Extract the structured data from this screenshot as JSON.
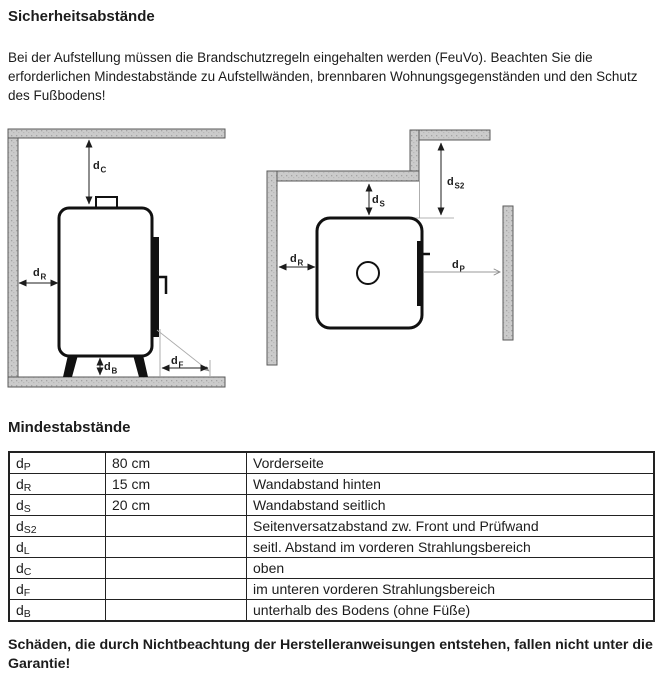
{
  "page": {
    "title": "Sicherheitsabstände",
    "intro": "Bei der Aufstellung müssen die Brandschutzregeln eingehalten werden (FeuVo). Beachten Sie die erforderlichen Mindestabstände zu Aufstellwänden, brennbaren Wohnungsgegenständen und den Schutz des Fußbodens!",
    "section2_title": "Mindestabstände",
    "warning": "Schäden, die durch Nichtbeachtung der Herstelleranweisungen entstehen, fallen nicht unter die Garantie!"
  },
  "colors": {
    "wall_fill": "#cbcbcb",
    "line": "#1c1c1c",
    "thin_line": "#9a9a9a"
  },
  "diagram": {
    "left": {
      "dC": {
        "base": "d",
        "sub": "C"
      },
      "dR": {
        "base": "d",
        "sub": "R"
      },
      "dB": {
        "base": "d",
        "sub": "B"
      },
      "dF": {
        "base": "d",
        "sub": "F"
      }
    },
    "right": {
      "dS": {
        "base": "d",
        "sub": "S"
      },
      "dS2": {
        "base": "d",
        "sub": "S2"
      },
      "dR": {
        "base": "d",
        "sub": "R"
      },
      "dP": {
        "base": "d",
        "sub": "P"
      }
    }
  },
  "table": {
    "rows": [
      {
        "base": "d",
        "sub": "P",
        "value": "80 cm",
        "desc": "Vorderseite"
      },
      {
        "base": "d",
        "sub": "R",
        "value": "15 cm",
        "desc": "Wandabstand hinten"
      },
      {
        "base": "d",
        "sub": "S",
        "value": "20 cm",
        "desc": "Wandabstand seitlich"
      },
      {
        "base": "d",
        "sub": "S2",
        "value": "",
        "desc": "Seitenversatzabstand zw. Front und Prüfwand"
      },
      {
        "base": "d",
        "sub": "L",
        "value": "",
        "desc": "seitl. Abstand im vorderen Strahlungsbereich"
      },
      {
        "base": "d",
        "sub": "C",
        "value": "",
        "desc": "oben"
      },
      {
        "base": "d",
        "sub": "F",
        "value": "",
        "desc": "im unteren vorderen Strahlungsbereich"
      },
      {
        "base": "d",
        "sub": "B",
        "value": "",
        "desc": "unterhalb des Bodens (ohne Füße)"
      }
    ]
  }
}
